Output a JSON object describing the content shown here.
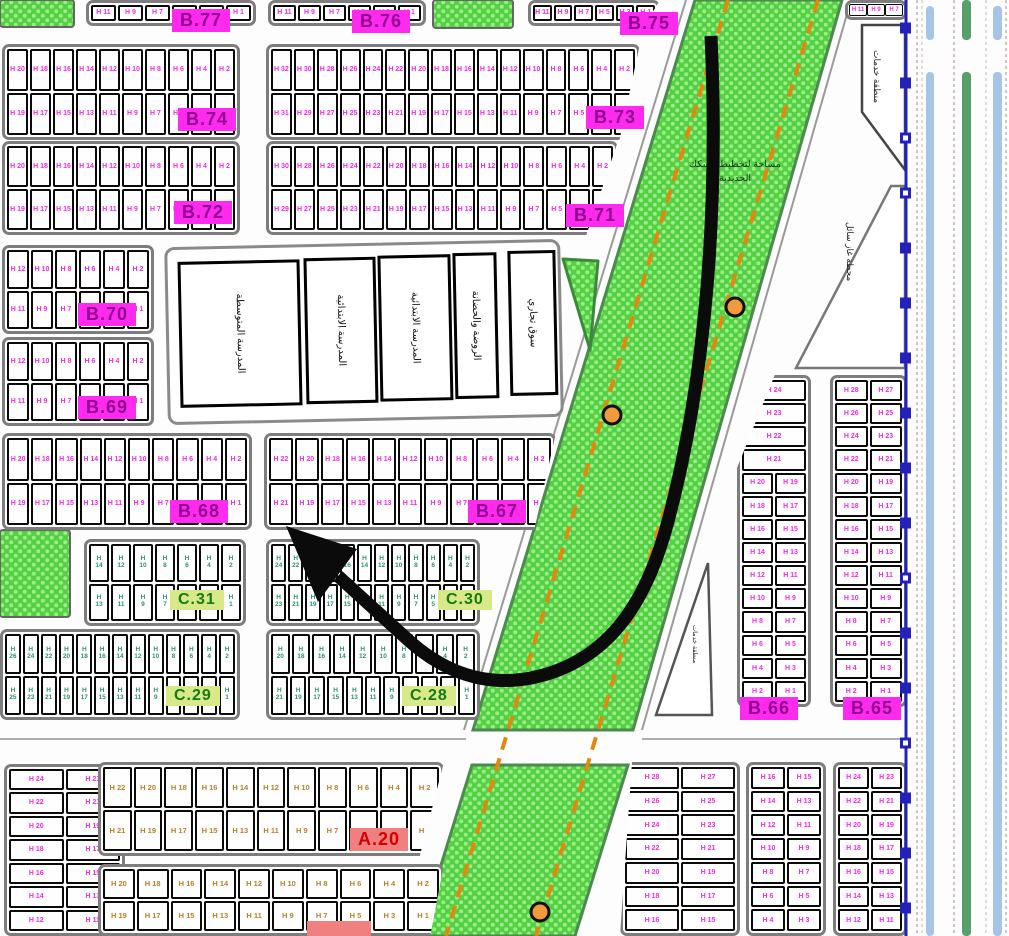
{
  "areas": {
    "strip_label": "مساحة لتخطيط السكك\nالحديدية",
    "services_1": "منطقة خدمات",
    "gas_station": "محطة غاز سائل",
    "services_2": "منطقة خدمات",
    "school_boxes": [
      "المدرسة المتوسطة",
      "المدرسة الابتدائية",
      "المدرسة الابتدائية",
      "الروضة والحضانة",
      "سوق تجاري"
    ]
  },
  "labels": [
    {
      "id": "b77",
      "text": "B.77",
      "cls": "lab-b"
    },
    {
      "id": "b76",
      "text": "B.76",
      "cls": "lab-b"
    },
    {
      "id": "b75",
      "text": "B.75",
      "cls": "lab-b"
    },
    {
      "id": "b74",
      "text": "B.74",
      "cls": "lab-b"
    },
    {
      "id": "b73",
      "text": "B.73",
      "cls": "lab-b"
    },
    {
      "id": "b72",
      "text": "B.72",
      "cls": "lab-b"
    },
    {
      "id": "b71",
      "text": "B.71",
      "cls": "lab-b"
    },
    {
      "id": "b70",
      "text": "B.70",
      "cls": "lab-b"
    },
    {
      "id": "b69",
      "text": "B.69",
      "cls": "lab-b"
    },
    {
      "id": "b68",
      "text": "B.68",
      "cls": "lab-b"
    },
    {
      "id": "b67",
      "text": "B.67",
      "cls": "lab-b"
    },
    {
      "id": "c31",
      "text": "C.31",
      "cls": "lab-c"
    },
    {
      "id": "c30",
      "text": "C.30",
      "cls": "lab-c"
    },
    {
      "id": "c29",
      "text": "C.29",
      "cls": "lab-c"
    },
    {
      "id": "c28",
      "text": "C.28",
      "cls": "lab-c"
    },
    {
      "id": "b66",
      "text": "B.66",
      "cls": "lab-b"
    },
    {
      "id": "b65",
      "text": "B.65",
      "cls": "lab-b"
    },
    {
      "id": "a20",
      "text": "A.20",
      "cls": "lab-a"
    },
    {
      "id": "a19",
      "text": "",
      "cls": "lab-a lab-partial"
    }
  ],
  "blocks": [
    {
      "id": "b77r",
      "ink": "ink-b",
      "rows": [
        [
          "H 11",
          "H 9",
          "H 7",
          "H 5",
          "H 3",
          "H 1"
        ]
      ]
    },
    {
      "id": "b76r",
      "ink": "ink-b",
      "rows": [
        [
          "H 11",
          "H 9",
          "H 7",
          "H 5",
          "H 3",
          "H 1"
        ]
      ]
    },
    {
      "id": "b75r",
      "ink": "ink-b",
      "rows": [
        [
          "H 11",
          "H 9",
          "H 7",
          "H 5",
          "H 3",
          "H 1"
        ]
      ]
    },
    {
      "id": "trr",
      "ink": "ink-b",
      "rows": [
        [
          "H 11",
          "H 9",
          "H 7"
        ]
      ]
    },
    {
      "id": "b74",
      "ink": "ink-b",
      "rows": [
        [
          "H 20",
          "H 18",
          "H 16",
          "H 14",
          "H 12",
          "H 10",
          "H 8",
          "H 6",
          "H 4",
          "H 2"
        ],
        [
          "H 19",
          "H 17",
          "H 15",
          "H 13",
          "H 11",
          "H 9",
          "H 7",
          "H 5",
          "H 3",
          "H 1"
        ]
      ]
    },
    {
      "id": "b73",
      "ink": "ink-b",
      "rows": [
        [
          "H 32",
          "H 30",
          "H 28",
          "H 26",
          "H 24",
          "H 22",
          "H 20",
          "H 18",
          "H 16",
          "H 14",
          "H 12",
          "H 10",
          "H 8",
          "H 6",
          "H 4",
          "H 2"
        ],
        [
          "H 31",
          "H 29",
          "H 27",
          "H 25",
          "H 23",
          "H 21",
          "H 19",
          "H 17",
          "H 15",
          "H 13",
          "H 11",
          "H 9",
          "H 7",
          "H 5",
          "H 3",
          "H 1"
        ]
      ]
    },
    {
      "id": "b72",
      "ink": "ink-b",
      "rows": [
        [
          "H 20",
          "H 18",
          "H 16",
          "H 14",
          "H 12",
          "H 10",
          "H 8",
          "H 6",
          "H 4",
          "H 2"
        ],
        [
          "H 19",
          "H 17",
          "H 15",
          "H 13",
          "H 11",
          "H 9",
          "H 7",
          "H 5",
          "H 3",
          "H 1"
        ]
      ]
    },
    {
      "id": "b71",
      "ink": "ink-b",
      "rows": [
        [
          "H 30",
          "H 28",
          "H 26",
          "H 24",
          "H 22",
          "H 20",
          "H 18",
          "H 16",
          "H 14",
          "H 12",
          "H 10",
          "H 8",
          "H 6",
          "H 4",
          "H 2"
        ],
        [
          "H 29",
          "H 27",
          "H 25",
          "H 23",
          "H 21",
          "H 19",
          "H 17",
          "H 15",
          "H 13",
          "H 11",
          "H 9",
          "H 7",
          "H 5",
          "H 3",
          "H 1"
        ]
      ]
    },
    {
      "id": "b70",
      "ink": "ink-b",
      "rows": [
        [
          "H 12",
          "H 10",
          "H 8",
          "H 6",
          "H 4",
          "H 2"
        ],
        [
          "H 11",
          "H 9",
          "H 7",
          "H 5",
          "H 3",
          "H 1"
        ]
      ]
    },
    {
      "id": "b69",
      "ink": "ink-b",
      "rows": [
        [
          "H 12",
          "H 10",
          "H 8",
          "H 6",
          "H 4",
          "H 2"
        ],
        [
          "H 11",
          "H 9",
          "H 7",
          "H 5",
          "H 3",
          "H 1"
        ]
      ]
    },
    {
      "id": "b68",
      "ink": "ink-b",
      "rows": [
        [
          "H 20",
          "H 18",
          "H 16",
          "H 14",
          "H 12",
          "H 10",
          "H 8",
          "H 6",
          "H 4",
          "H 2"
        ],
        [
          "H 19",
          "H 17",
          "H 15",
          "H 13",
          "H 11",
          "H 9",
          "H 7",
          "H 5",
          "H 3",
          "H 1"
        ]
      ]
    },
    {
      "id": "b67",
      "ink": "ink-b",
      "rows": [
        [
          "H 22",
          "H 20",
          "H 18",
          "H 16",
          "H 14",
          "H 12",
          "H 10",
          "H 8",
          "H 6",
          "H 4",
          "H 2"
        ],
        [
          "H 21",
          "H 19",
          "H 17",
          "H 15",
          "H 13",
          "H 11",
          "H 9",
          "H 7",
          "H 5",
          "H 3",
          "H 1"
        ]
      ]
    },
    {
      "id": "c31",
      "ink": "ink-c",
      "rows": [
        [
          "H\n14",
          "H\n12",
          "H\n10",
          "H\n8",
          "H\n6",
          "H\n4",
          "H\n2"
        ],
        [
          "H\n13",
          "H\n11",
          "H\n9",
          "H\n7",
          "H\n5",
          "H\n3",
          "H\n1"
        ]
      ]
    },
    {
      "id": "c30",
      "ink": "ink-c",
      "rows": [
        [
          "H\n24",
          "H\n22",
          "H\n20",
          "H\n18",
          "H\n16",
          "H\n14",
          "H\n12",
          "H\n10",
          "H\n8",
          "H\n6",
          "H\n4",
          "H\n2"
        ],
        [
          "H\n23",
          "H\n21",
          "H\n19",
          "H\n17",
          "H\n15",
          "H\n13",
          "H\n11",
          "H\n9",
          "H\n7",
          "H\n5",
          "H\n3",
          "H\n1"
        ]
      ]
    },
    {
      "id": "c29",
      "ink": "ink-c",
      "rows": [
        [
          "H\n26",
          "H\n24",
          "H\n22",
          "H\n20",
          "H\n18",
          "H\n16",
          "H\n14",
          "H\n12",
          "H\n10",
          "H\n8",
          "H\n6",
          "H\n4",
          "H\n2"
        ],
        [
          "H\n25",
          "H\n23",
          "H\n21",
          "H\n19",
          "H\n17",
          "H\n15",
          "H\n13",
          "H\n11",
          "H\n9",
          "H\n7",
          "H\n5",
          "H\n3",
          "H\n1"
        ]
      ]
    },
    {
      "id": "c28",
      "ink": "ink-c",
      "rows": [
        [
          "H\n20",
          "H\n18",
          "H\n16",
          "H\n14",
          "H\n12",
          "H\n10",
          "H\n8",
          "H\n6",
          "H\n4",
          "H\n2"
        ],
        [
          "H\n21",
          "H\n19",
          "H\n17",
          "H\n15",
          "H\n13",
          "H\n11",
          "H\n9",
          "H\n7",
          "H\n5",
          "H\n3",
          "H\n1"
        ]
      ]
    },
    {
      "id": "b66",
      "ink": "ink-b",
      "rows": [
        [
          "H 24"
        ],
        [
          "H 23"
        ],
        [
          "H 22"
        ],
        [
          "H 21"
        ],
        [
          "H 20",
          "H 19"
        ],
        [
          "H 18",
          "H 17"
        ],
        [
          "H 16",
          "H 15"
        ],
        [
          "H 14",
          "H 13"
        ],
        [
          "H 12",
          "H 11"
        ],
        [
          "H 10",
          "H 9"
        ],
        [
          "H 8",
          "H 7"
        ],
        [
          "H 6",
          "H 5"
        ],
        [
          "H 4",
          "H 3"
        ],
        [
          "H 2",
          "H 1"
        ]
      ]
    },
    {
      "id": "b65",
      "ink": "ink-b",
      "rows": [
        [
          "H 28",
          "H 27"
        ],
        [
          "H 26",
          "H 25"
        ],
        [
          "H 24",
          "H 23"
        ],
        [
          "H 22",
          "H 21"
        ],
        [
          "H 20",
          "H 19"
        ],
        [
          "H 18",
          "H 17"
        ],
        [
          "H 16",
          "H 15"
        ],
        [
          "H 14",
          "H 13"
        ],
        [
          "H 12",
          "H 11"
        ],
        [
          "H 10",
          "H 9"
        ],
        [
          "H 8",
          "H 7"
        ],
        [
          "H 6",
          "H 5"
        ],
        [
          "H 4",
          "H 3"
        ],
        [
          "H 2",
          "H 1"
        ]
      ]
    },
    {
      "id": "blv",
      "ink": "ink-b",
      "rows": [
        [
          "H 24",
          "H 23"
        ],
        [
          "H 22",
          "H 21"
        ],
        [
          "H 20",
          "H 19"
        ],
        [
          "H 18",
          "H 17"
        ],
        [
          "H 16",
          "H 15"
        ],
        [
          "H 14",
          "H 13"
        ],
        [
          "H 12",
          "H 11"
        ]
      ]
    },
    {
      "id": "a20",
      "ink": "ink-a",
      "rows": [
        [
          "H 22",
          "H 20",
          "H 18",
          "H 16",
          "H 14",
          "H 12",
          "H 10",
          "H 8",
          "H 6",
          "H 4",
          "H 2"
        ],
        [
          "H 21",
          "H 19",
          "H 17",
          "H 15",
          "H 13",
          "H 11",
          "H 9",
          "H 7",
          "H 5",
          "H 3",
          "H 1"
        ]
      ]
    },
    {
      "id": "a19",
      "ink": "ink-a",
      "rows": [
        [
          "H 20",
          "H 18",
          "H 16",
          "H 14",
          "H 12",
          "H 10",
          "H 8",
          "H 6",
          "H 4",
          "H 2"
        ],
        [
          "H 19",
          "H 17",
          "H 15",
          "H 13",
          "H 11",
          "H 9",
          "H 7",
          "H 5",
          "H 3",
          "H 1"
        ]
      ]
    },
    {
      "id": "br1",
      "ink": "ink-b",
      "rows": [
        [
          "H 28",
          "H 27"
        ],
        [
          "H 26",
          "H 25"
        ],
        [
          "H 24",
          "H 23"
        ],
        [
          "H 22",
          "H 21"
        ],
        [
          "H 20",
          "H 19"
        ],
        [
          "H 18",
          "H 17"
        ],
        [
          "H 16",
          "H 15"
        ]
      ]
    },
    {
      "id": "br2",
      "ink": "ink-b",
      "rows": [
        [
          "H 16",
          "H 15"
        ],
        [
          "H 14",
          "H 13"
        ],
        [
          "H 12",
          "H 11"
        ],
        [
          "H 10",
          "H 9"
        ],
        [
          "H 8",
          "H 7"
        ],
        [
          "H 6",
          "H 5"
        ],
        [
          "H 4",
          "H 3"
        ]
      ]
    },
    {
      "id": "br3",
      "ink": "ink-b",
      "rows": [
        [
          "H 24",
          "H 23"
        ],
        [
          "H 22",
          "H 21"
        ],
        [
          "H 20",
          "H 19"
        ],
        [
          "H 18",
          "H 17"
        ],
        [
          "H 16",
          "H 15"
        ],
        [
          "H 14",
          "H 13"
        ],
        [
          "H 12",
          "H 11"
        ]
      ]
    }
  ],
  "colors": {
    "b_label_bg": "#fe2bee",
    "b_label_text": "#8f0090",
    "c_label_bg": "#d8e98a",
    "c_label_text": "#157a15",
    "a_label_bg": "#f08080",
    "a_label_text": "#d40000",
    "plot_text_b": "#f32be3",
    "plot_text_c": "#2d9467",
    "plot_text_a": "#bc7e28",
    "green_area": "#55cf43",
    "power_corridor_dash": "#e5870f",
    "transit_line": "#2222bb",
    "road_band_blue": "#a6c4e6",
    "road_band_green": "#57a06a"
  }
}
